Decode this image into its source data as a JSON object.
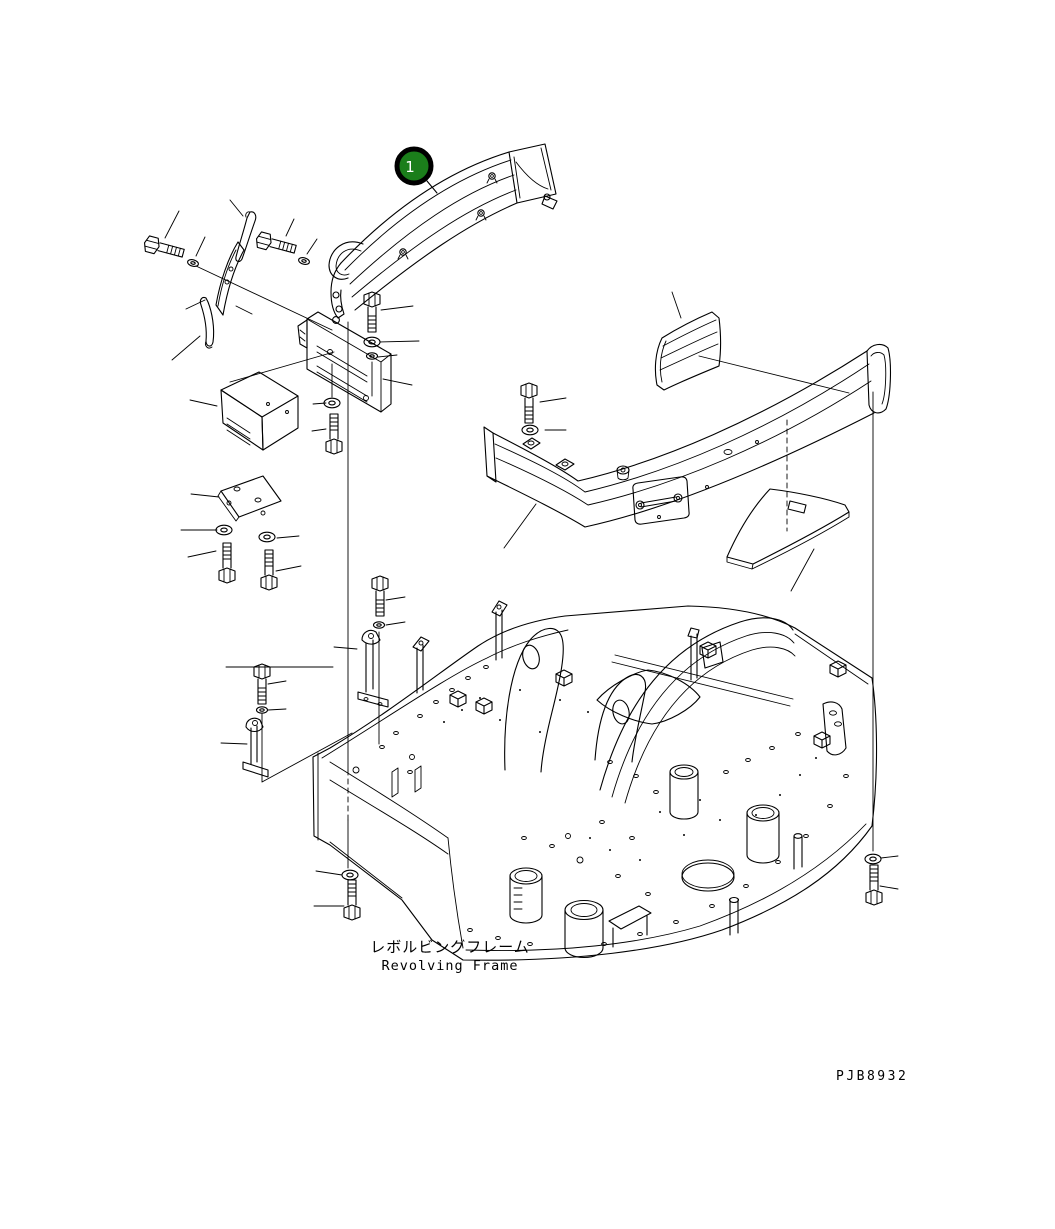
{
  "page": {
    "background": "#ffffff",
    "width": 1055,
    "height": 1229
  },
  "diagram": {
    "type": "exploded-parts-diagram",
    "line_color": "#000000",
    "caption": {
      "jp": "レボルビングフレーム",
      "en": "Revolving Frame"
    },
    "drawing_number": "PJB8932",
    "callouts": [
      {
        "label": "1",
        "fill": "#1b7e1b",
        "ring": "#000000",
        "text_color": "#ffffff",
        "part": "guard-rail"
      }
    ],
    "parts": [
      "guard-rail",
      "handle-loop",
      "mounting-clips",
      "retainer-strip",
      "mounting-bracket",
      "cover-box",
      "mounting-plate",
      "pad",
      "bumper-guard",
      "side-plate",
      "frame-straps",
      "revolving-frame",
      "hex-bolts",
      "washers"
    ]
  }
}
